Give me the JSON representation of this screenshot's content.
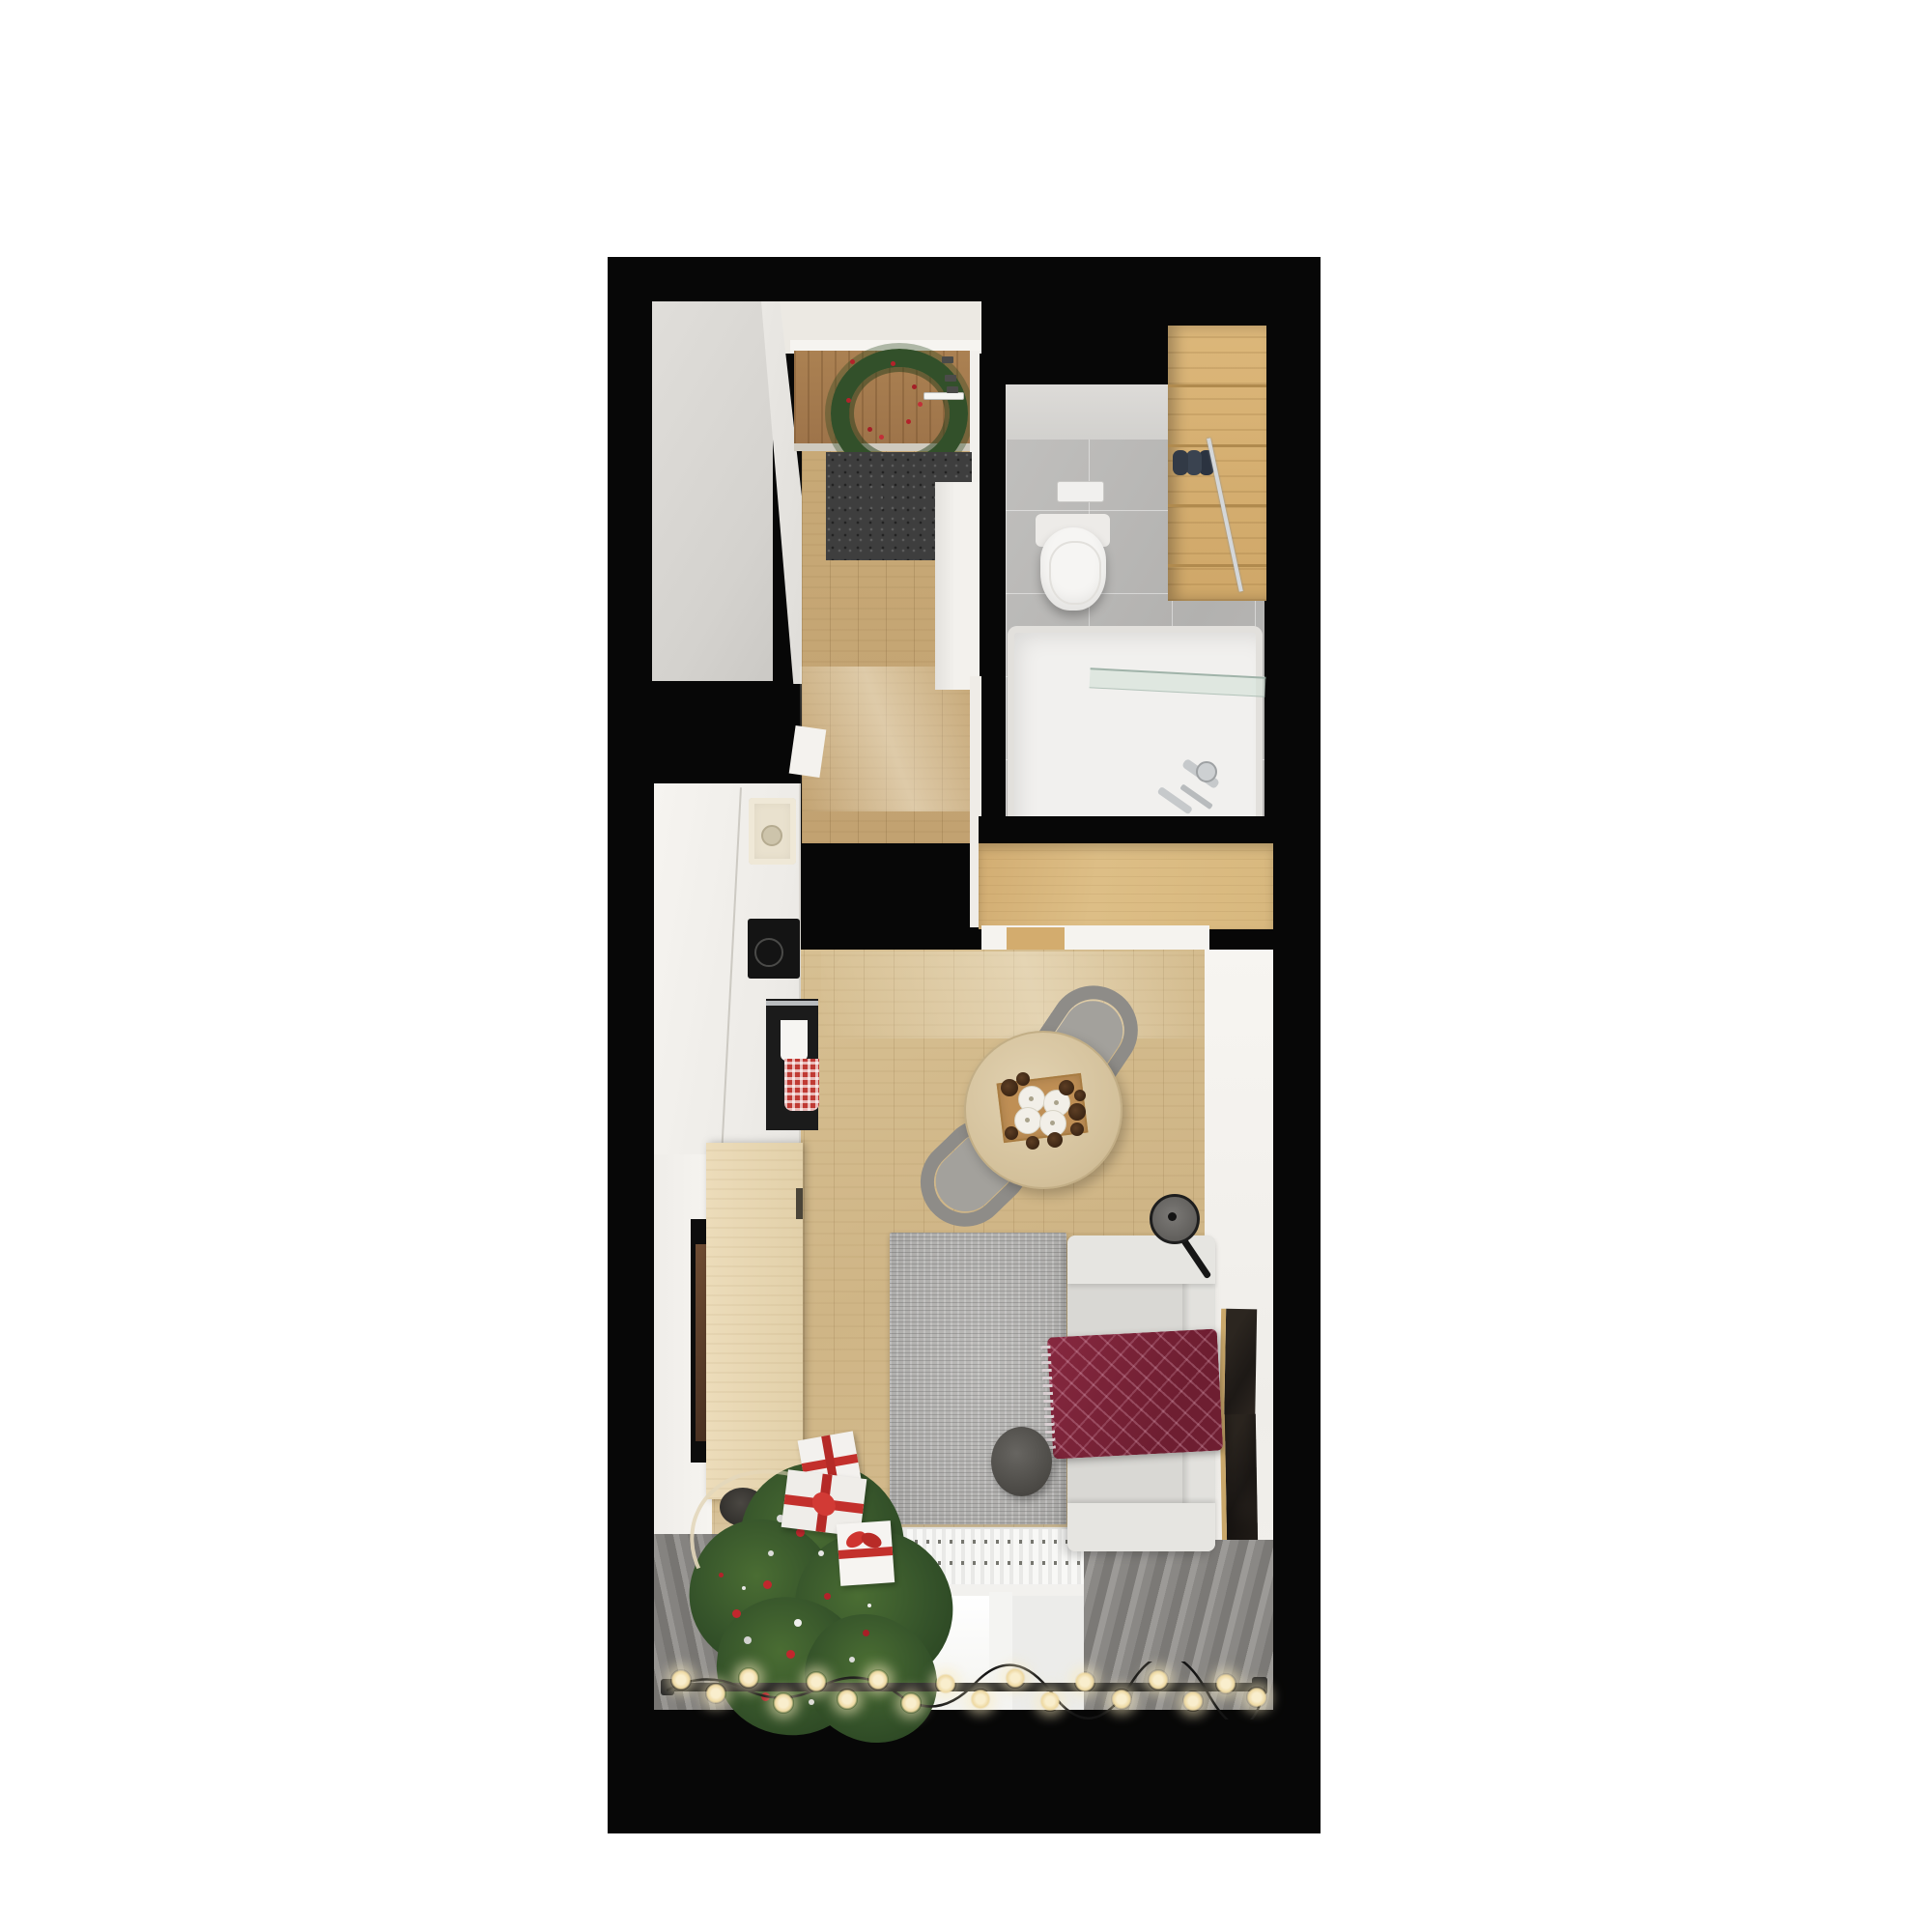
{
  "scene": {
    "type": "apartment-floor-plan-3d-render",
    "view": "top-down",
    "theme": "christmas-decorated studio apartment",
    "rooms": [
      {
        "name": "entry-hall",
        "objects": [
          "wardrobe",
          "entry-door",
          "christmas-wreath",
          "door-handle",
          "doormat",
          "hall-cabinet"
        ]
      },
      {
        "name": "bathroom",
        "objects": [
          "toilet",
          "flush-plate",
          "wooden-shelf-unit",
          "towel-rolls",
          "towel-bar",
          "bathtub",
          "glass-screen",
          "bath-faucet"
        ],
        "counts": {
          "towel_rolls": 3
        }
      },
      {
        "name": "kitchen",
        "objects": [
          "white-cabinets",
          "sink",
          "induction-cooktop",
          "oven",
          "white-kitchen-towel",
          "red-checkered-towel"
        ]
      },
      {
        "name": "living-room",
        "objects": [
          "wall-closet",
          "dining-table",
          "candle-tray",
          "candles",
          "pinecones",
          "dining-chairs",
          "floor-lamp",
          "rug",
          "sofa",
          "throw-blanket",
          "pouf",
          "tv",
          "tv-sideboard",
          "storage-basket",
          "wall-art-frames",
          "radiator",
          "windows",
          "curtains",
          "curtain-rod",
          "string-lights",
          "christmas-tree",
          "gift-boxes"
        ],
        "counts": {
          "candles": 4,
          "pinecones": 9,
          "dining_chairs": 2,
          "wall_art_frames": 2,
          "gift_boxes": 3,
          "string_light_bulbs": 18,
          "window_panes": 3
        }
      }
    ],
    "palette": {
      "background": "#ffffff",
      "walls_black": "#070707",
      "wall_light": "#f2f0ec",
      "wardrobe_gray": "#d9d7d3",
      "door_wood": "#a87e50",
      "hall_floor_wood": "#c7a977",
      "living_floor_wood": "#d2ba8c",
      "closet_wood": "#d9b87e",
      "bath_floor_tile": "#b8b7b5",
      "bath_wall_tile": "#d8d6d3",
      "shelf_wood": "#d5ae6e",
      "towel_navy": "#323a46",
      "sanitary_white": "#f5f4f2",
      "doormat_gray": "#3e3e3e",
      "rug_gray": "#b4b3b1",
      "sofa_gray": "#dcdbd7",
      "blanket_burgundy": "#7c2339",
      "frame_gold": "#c9a76a",
      "ornament_red": "#c1272d",
      "tree_green": "#35552a",
      "candle_white": "#f2efe8",
      "radiator_white": "#f8f8f6",
      "bulb_warm": "#f3dfae",
      "curtain_gray": "#8f8d8a",
      "pouf_dark": "#57544f",
      "table_wood": "#d8c59f",
      "tray_wood": "#bf8f55",
      "lamp_black": "#1a1a1a"
    }
  }
}
